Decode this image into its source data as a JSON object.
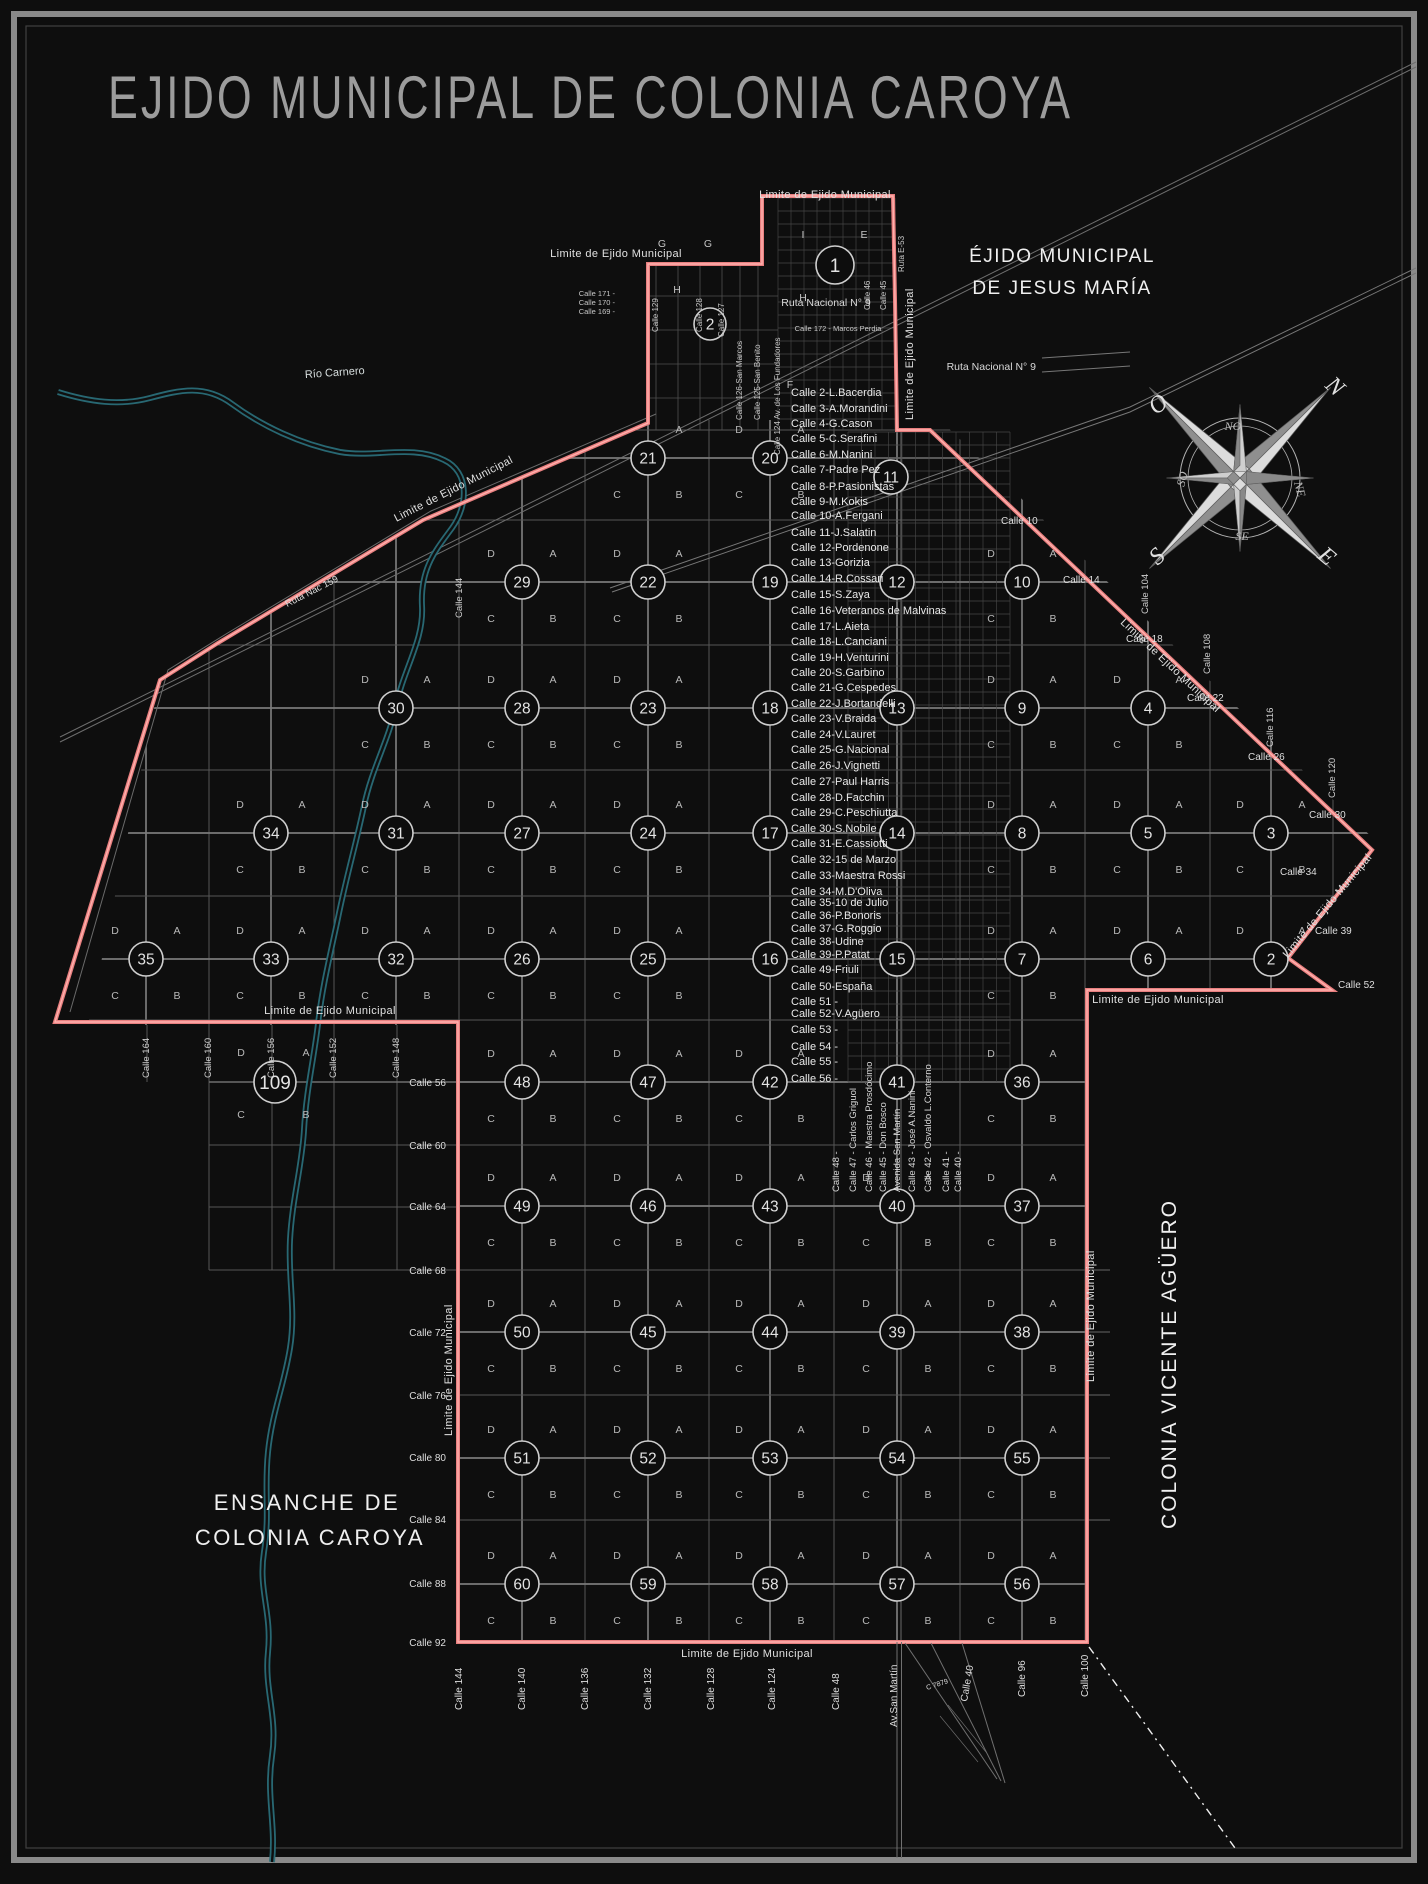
{
  "title": "EJIDO MUNICIPAL DE COLONIA CAROYA",
  "regions": {
    "jesus_maria_1": "ÉJIDO MUNICIPAL",
    "jesus_maria_2": "DE JESUS MARÍA",
    "ensanche_1": "ENSANCHE DE",
    "ensanche_2": "COLONIA CAROYA",
    "vicente_aguero": "COLONIA VICENTE AGÜERO"
  },
  "roads": {
    "limite": "Limite de Ejido Municipal",
    "ruta9": "Ruta Nacional N° 9",
    "ruta159": "Ruta Nac 159",
    "rio": "Río Carnero"
  },
  "compass": {
    "cardinal": [
      "N",
      "E",
      "S",
      "O"
    ],
    "intercardinal": [
      "NO",
      "NE",
      "SE",
      "SO"
    ]
  },
  "quadrant_letters": {
    "tr": "A",
    "tl": "D",
    "bl": "C",
    "br": "B"
  },
  "street_list": [
    {
      "label": "Calle 2-L.Bacerdia",
      "y": 396
    },
    {
      "label": "Calle 3-A.Morandini",
      "y": 412
    },
    {
      "label": "Calle 4-G.Cason",
      "y": 427
    },
    {
      "label": "Calle 5-C.Serafini",
      "y": 442
    },
    {
      "label": "Calle 6-M.Nanini",
      "y": 458
    },
    {
      "label": "Calle 7-Padre Pez",
      "y": 473
    },
    {
      "label": "Calle 8-P.Pasionistas",
      "y": 490
    },
    {
      "label": "Calle 9-M.Kokis",
      "y": 505
    },
    {
      "label": "Calle 10-A.Fergani",
      "y": 519
    },
    {
      "label": "Calle 11-J.Salatin",
      "y": 536
    },
    {
      "label": "Calle 12-Pordenone",
      "y": 551
    },
    {
      "label": "Calle 13-Gorizia",
      "y": 566
    },
    {
      "label": "Calle 14-R.Cossari",
      "y": 582
    },
    {
      "label": "Calle 15-S.Zaya",
      "y": 598
    },
    {
      "label": "Calle 16-Veteranos de Malvinas",
      "y": 614
    },
    {
      "label": "Calle 17-L.Aieta",
      "y": 630
    },
    {
      "label": "Calle 18-L.Canciani",
      "y": 645
    },
    {
      "label": "Calle 19-H.Venturini",
      "y": 661
    },
    {
      "label": "Calle 20-S.Garbino",
      "y": 676
    },
    {
      "label": "Calle 21-G.Cespedes",
      "y": 691
    },
    {
      "label": "Calle 22-J.Bortandelli",
      "y": 707
    },
    {
      "label": "Calle 23-V.Braida",
      "y": 722
    },
    {
      "label": "Calle 24-V.Lauret",
      "y": 738
    },
    {
      "label": "Calle 25-G.Nacional",
      "y": 753
    },
    {
      "label": "Calle 26-J.Vignetti",
      "y": 769
    },
    {
      "label": "Calle 27-Paul Harris",
      "y": 785
    },
    {
      "label": "Calle 28-D.Facchin",
      "y": 801
    },
    {
      "label": "Calle 29-C.Peschiutta",
      "y": 816
    },
    {
      "label": "Calle 30-S.Nobile",
      "y": 832
    },
    {
      "label": "Calle 31-E.Cassiotti",
      "y": 847
    },
    {
      "label": "Calle 32-15 de Marzo",
      "y": 863
    },
    {
      "label": "Calle 33-Maestra Rossi",
      "y": 879
    },
    {
      "label": "Calle 34-M.D'Oliva",
      "y": 895
    },
    {
      "label": "Calle 35-10 de Julio",
      "y": 906
    },
    {
      "label": "Calle 36-P.Bonoris",
      "y": 919
    },
    {
      "label": "Calle 37-G.Roggio",
      "y": 932
    },
    {
      "label": "Calle 38-Udine",
      "y": 945
    },
    {
      "label": "Calle 39-P.Patat",
      "y": 958
    },
    {
      "label": "Calle 49-Friuli",
      "y": 973
    },
    {
      "label": "Calle 50-España",
      "y": 990
    },
    {
      "label": "Calle 51 -",
      "y": 1005
    },
    {
      "label": "Calle 52-V.Agüero",
      "y": 1017
    },
    {
      "label": "Calle 53 -",
      "y": 1033
    },
    {
      "label": "Calle 54 -",
      "y": 1050
    },
    {
      "label": "Calle 55 -",
      "y": 1065
    },
    {
      "label": "Calle 56 -",
      "y": 1082
    }
  ],
  "center_vertical_streets": [
    {
      "label": "Calle 48 -",
      "x": 836
    },
    {
      "label": "Calle 47 - Carlos Griguol",
      "x": 853
    },
    {
      "label": "Calle 46 - Maestra Prosdócimo",
      "x": 869
    },
    {
      "label": "Calle 45 - Don Bosco",
      "x": 883
    },
    {
      "label": "Avenida San Martín",
      "x": 897
    },
    {
      "label": "Calle 43 - José A.Nanini",
      "x": 912
    },
    {
      "label": "Calle 42 - Osvaldo L.Conterno",
      "x": 928
    },
    {
      "label": "Calle 41 -",
      "x": 946
    },
    {
      "label": "Calle 40 -",
      "x": 958
    }
  ],
  "bottom_streets": [
    {
      "label": "Calle 144",
      "x": 459,
      "y": 1710,
      "rot": -90
    },
    {
      "label": "Calle 140",
      "x": 522,
      "y": 1710,
      "rot": -90
    },
    {
      "label": "Calle 136",
      "x": 585,
      "y": 1710,
      "rot": -90
    },
    {
      "label": "Calle 132",
      "x": 648,
      "y": 1710,
      "rot": -90
    },
    {
      "label": "Calle 128",
      "x": 711,
      "y": 1710,
      "rot": -90
    },
    {
      "label": "Calle 124",
      "x": 772,
      "y": 1710,
      "rot": -90
    },
    {
      "label": "Calle 48",
      "x": 836,
      "y": 1710,
      "rot": -90
    },
    {
      "label": "Av.San Martín",
      "x": 894,
      "y": 1727,
      "rot": -90
    },
    {
      "label": "C 7879",
      "x": 924,
      "y": 1690,
      "rot": -18,
      "fs": 7
    },
    {
      "label": "Calle 40",
      "x": 964,
      "y": 1702,
      "rot": -80
    },
    {
      "label": "Calle 96",
      "x": 1022,
      "y": 1697,
      "rot": -90
    },
    {
      "label": "Calle 100",
      "x": 1085,
      "y": 1697,
      "rot": -90
    }
  ],
  "left_streets": [
    {
      "label": "Calle 56",
      "y": 1086
    },
    {
      "label": "Calle 60",
      "y": 1149
    },
    {
      "label": "Calle 64",
      "y": 1210
    },
    {
      "label": "Calle 68",
      "y": 1274
    },
    {
      "label": "Calle 72",
      "y": 1336
    },
    {
      "label": "Calle 76",
      "y": 1399
    },
    {
      "label": "Calle 80",
      "y": 1461
    },
    {
      "label": "Calle 84",
      "y": 1523
    },
    {
      "label": "Calle 88",
      "y": 1587
    },
    {
      "label": "Calle 92",
      "y": 1646
    }
  ],
  "right_streets": [
    {
      "label": "Calle 10",
      "x": 1001,
      "y": 524
    },
    {
      "label": "Calle 14",
      "x": 1063,
      "y": 583
    },
    {
      "label": "Calle 18",
      "x": 1126,
      "y": 642
    },
    {
      "label": "Calle 22",
      "x": 1187,
      "y": 701
    },
    {
      "label": "Calle 26",
      "x": 1248,
      "y": 760
    },
    {
      "label": "Calle 30",
      "x": 1309,
      "y": 818
    },
    {
      "label": "Calle 34",
      "x": 1280,
      "y": 875
    },
    {
      "label": "Calle 39",
      "x": 1315,
      "y": 934
    },
    {
      "label": "Calle 52",
      "x": 1338,
      "y": 988
    }
  ],
  "right_vertical_streets": [
    {
      "label": "Calle 104",
      "x": 1148,
      "y": 614
    },
    {
      "label": "Calle 108",
      "x": 1210,
      "y": 674
    },
    {
      "label": "Calle 116",
      "x": 1273,
      "y": 747
    },
    {
      "label": "Calle 120",
      "x": 1335,
      "y": 798
    },
    {
      "label": "Calle 144",
      "x": 462,
      "y": 618
    }
  ],
  "block109_streets": [
    {
      "label": "Calle 164",
      "x": 149,
      "y": 1078
    },
    {
      "label": "Calle 160",
      "x": 211,
      "y": 1078
    },
    {
      "label": "Calle 156",
      "x": 274,
      "y": 1078
    },
    {
      "label": "Calle 152",
      "x": 336,
      "y": 1078
    },
    {
      "label": "Calle 148",
      "x": 399,
      "y": 1078
    }
  ],
  "top_vertical_streets": [
    {
      "label": "Calle 129",
      "x": 658,
      "y": 332
    },
    {
      "label": "Calle 128",
      "x": 702,
      "y": 332
    },
    {
      "label": "Calle 127",
      "x": 724,
      "y": 337
    },
    {
      "label": "Calle 126-San Marcos",
      "x": 742,
      "y": 420
    },
    {
      "label": "Calle 125-San Benito",
      "x": 760,
      "y": 420
    },
    {
      "label": "Calle 124 Av. de Los Fundadores",
      "x": 780,
      "y": 455
    },
    {
      "label": "Calle 46",
      "x": 870,
      "y": 310
    },
    {
      "label": "Calle 45",
      "x": 886,
      "y": 310
    },
    {
      "label": "Ruta E-53",
      "x": 904,
      "y": 272
    }
  ],
  "top_small_streets": [
    {
      "label": "Calle 171 -",
      "x": 615,
      "y": 296
    },
    {
      "label": "Calle 170 -",
      "x": 615,
      "y": 305
    },
    {
      "label": "Calle 169 -",
      "x": 615,
      "y": 314
    },
    {
      "label": "Calle 172 - Marcos Perdia",
      "x": 838,
      "y": 331
    }
  ],
  "limite_positions": [
    {
      "x": 616,
      "y": 257,
      "rot": 0,
      "a": "middle"
    },
    {
      "x": 825,
      "y": 198,
      "rot": 0,
      "a": "middle"
    },
    {
      "x": 913,
      "y": 420,
      "rot": -90,
      "a": "start"
    },
    {
      "x": 455,
      "y": 492,
      "rot": -27,
      "a": "middle"
    },
    {
      "x": 330,
      "y": 1014,
      "rot": 0,
      "a": "middle"
    },
    {
      "x": 1158,
      "y": 1003,
      "rot": 0,
      "a": "middle"
    },
    {
      "x": 1168,
      "y": 668,
      "rot": 43,
      "a": "middle"
    },
    {
      "x": 1330,
      "y": 908,
      "rot": -50,
      "a": "middle"
    },
    {
      "x": 1094,
      "y": 1382,
      "rot": -90,
      "a": "start"
    },
    {
      "x": 747,
      "y": 1657,
      "rot": 0,
      "a": "middle"
    },
    {
      "x": 452,
      "y": 1436,
      "rot": -90,
      "a": "start"
    }
  ],
  "circles": [
    {
      "n": "1",
      "x": 835,
      "y": 265,
      "r": 19,
      "gen": false
    },
    {
      "n": "2",
      "x": 710,
      "y": 324,
      "r": 16,
      "gen": false
    },
    {
      "n": "21",
      "x": 648,
      "y": 458,
      "r": 17,
      "gen": true
    },
    {
      "n": "20",
      "x": 770,
      "y": 458,
      "r": 17,
      "gen": true
    },
    {
      "n": "11",
      "x": 891,
      "y": 477,
      "r": 17,
      "gen": false
    },
    {
      "n": "29",
      "x": 522,
      "y": 582,
      "r": 17,
      "gen": true
    },
    {
      "n": "22",
      "x": 648,
      "y": 582,
      "r": 17,
      "gen": true
    },
    {
      "n": "19",
      "x": 770,
      "y": 582,
      "r": 17,
      "gen": false
    },
    {
      "n": "12",
      "x": 897,
      "y": 582,
      "r": 17,
      "gen": false
    },
    {
      "n": "10",
      "x": 1022,
      "y": 582,
      "r": 17,
      "gen": true
    },
    {
      "n": "30",
      "x": 396,
      "y": 708,
      "r": 17,
      "gen": true
    },
    {
      "n": "28",
      "x": 522,
      "y": 708,
      "r": 17,
      "gen": true
    },
    {
      "n": "23",
      "x": 648,
      "y": 708,
      "r": 17,
      "gen": true
    },
    {
      "n": "18",
      "x": 770,
      "y": 708,
      "r": 17,
      "gen": false
    },
    {
      "n": "13",
      "x": 897,
      "y": 708,
      "r": 17,
      "gen": false
    },
    {
      "n": "9",
      "x": 1022,
      "y": 708,
      "r": 17,
      "gen": true
    },
    {
      "n": "4",
      "x": 1148,
      "y": 708,
      "r": 17,
      "gen": true
    },
    {
      "n": "34",
      "x": 271,
      "y": 833,
      "r": 17,
      "gen": true
    },
    {
      "n": "31",
      "x": 396,
      "y": 833,
      "r": 17,
      "gen": true
    },
    {
      "n": "27",
      "x": 522,
      "y": 833,
      "r": 17,
      "gen": true
    },
    {
      "n": "24",
      "x": 648,
      "y": 833,
      "r": 17,
      "gen": true
    },
    {
      "n": "17",
      "x": 770,
      "y": 833,
      "r": 17,
      "gen": false
    },
    {
      "n": "14",
      "x": 897,
      "y": 833,
      "r": 17,
      "gen": false
    },
    {
      "n": "8",
      "x": 1022,
      "y": 833,
      "r": 17,
      "gen": true
    },
    {
      "n": "5",
      "x": 1148,
      "y": 833,
      "r": 17,
      "gen": true
    },
    {
      "n": "3",
      "x": 1271,
      "y": 833,
      "r": 17,
      "gen": true
    },
    {
      "n": "35",
      "x": 146,
      "y": 959,
      "r": 17,
      "gen": true
    },
    {
      "n": "33",
      "x": 271,
      "y": 959,
      "r": 17,
      "gen": true
    },
    {
      "n": "32",
      "x": 396,
      "y": 959,
      "r": 17,
      "gen": true
    },
    {
      "n": "26",
      "x": 522,
      "y": 959,
      "r": 17,
      "gen": true
    },
    {
      "n": "25",
      "x": 648,
      "y": 959,
      "r": 17,
      "gen": true
    },
    {
      "n": "16",
      "x": 770,
      "y": 959,
      "r": 17,
      "gen": false
    },
    {
      "n": "15",
      "x": 897,
      "y": 959,
      "r": 17,
      "gen": false
    },
    {
      "n": "7",
      "x": 1022,
      "y": 959,
      "r": 17,
      "gen": true
    },
    {
      "n": "6",
      "x": 1148,
      "y": 959,
      "r": 17,
      "gen": true
    },
    {
      "n": "2",
      "x": 1271,
      "y": 959,
      "r": 17,
      "gen": true
    },
    {
      "n": "109",
      "x": 275,
      "y": 1082,
      "r": 21,
      "gen": false
    },
    {
      "n": "48",
      "x": 522,
      "y": 1082,
      "r": 17,
      "gen": true
    },
    {
      "n": "47",
      "x": 648,
      "y": 1082,
      "r": 17,
      "gen": true
    },
    {
      "n": "42",
      "x": 770,
      "y": 1082,
      "r": 17,
      "gen": true
    },
    {
      "n": "41",
      "x": 897,
      "y": 1082,
      "r": 17,
      "gen": false
    },
    {
      "n": "36",
      "x": 1022,
      "y": 1082,
      "r": 17,
      "gen": true
    },
    {
      "n": "49",
      "x": 522,
      "y": 1206,
      "r": 17,
      "gen": true
    },
    {
      "n": "46",
      "x": 648,
      "y": 1206,
      "r": 17,
      "gen": true
    },
    {
      "n": "43",
      "x": 770,
      "y": 1206,
      "r": 17,
      "gen": true
    },
    {
      "n": "40",
      "x": 897,
      "y": 1206,
      "r": 17,
      "gen": true
    },
    {
      "n": "37",
      "x": 1022,
      "y": 1206,
      "r": 17,
      "gen": true
    },
    {
      "n": "50",
      "x": 522,
      "y": 1332,
      "r": 17,
      "gen": true
    },
    {
      "n": "45",
      "x": 648,
      "y": 1332,
      "r": 17,
      "gen": true
    },
    {
      "n": "44",
      "x": 770,
      "y": 1332,
      "r": 17,
      "gen": true
    },
    {
      "n": "39",
      "x": 897,
      "y": 1332,
      "r": 17,
      "gen": true
    },
    {
      "n": "38",
      "x": 1022,
      "y": 1332,
      "r": 17,
      "gen": true
    },
    {
      "n": "51",
      "x": 522,
      "y": 1458,
      "r": 17,
      "gen": true
    },
    {
      "n": "52",
      "x": 648,
      "y": 1458,
      "r": 17,
      "gen": true
    },
    {
      "n": "53",
      "x": 770,
      "y": 1458,
      "r": 17,
      "gen": true
    },
    {
      "n": "54",
      "x": 897,
      "y": 1458,
      "r": 17,
      "gen": true
    },
    {
      "n": "55",
      "x": 1022,
      "y": 1458,
      "r": 17,
      "gen": true
    },
    {
      "n": "60",
      "x": 522,
      "y": 1584,
      "r": 17,
      "gen": true
    },
    {
      "n": "59",
      "x": 648,
      "y": 1584,
      "r": 17,
      "gen": true
    },
    {
      "n": "58",
      "x": 770,
      "y": 1584,
      "r": 17,
      "gen": true
    },
    {
      "n": "57",
      "x": 897,
      "y": 1584,
      "r": 17,
      "gen": true
    },
    {
      "n": "56",
      "x": 1022,
      "y": 1584,
      "r": 17,
      "gen": true
    }
  ],
  "block109_letters": [
    {
      "t": "D",
      "x": 241,
      "y": 1056
    },
    {
      "t": "A",
      "x": 306,
      "y": 1056
    },
    {
      "t": "C",
      "x": 241,
      "y": 1118
    },
    {
      "t": "B",
      "x": 306,
      "y": 1118
    }
  ],
  "extra_letters": [
    {
      "t": "I",
      "x": 803,
      "y": 238
    },
    {
      "t": "E",
      "x": 864,
      "y": 238
    },
    {
      "t": "G",
      "x": 662,
      "y": 247
    },
    {
      "t": "G",
      "x": 708,
      "y": 247
    },
    {
      "t": "H",
      "x": 677,
      "y": 293
    },
    {
      "t": "H",
      "x": 803,
      "y": 301
    },
    {
      "t": "F",
      "x": 790,
      "y": 388
    }
  ],
  "colors": {
    "boundary": "#ef8d8d",
    "boundary_core": "#ffb0ad",
    "river": "#2a6e79",
    "grid_major": "#7a7a7a",
    "grid_minor": "#565656",
    "text": "#e6e6e6",
    "title": "#9c9c9c"
  }
}
